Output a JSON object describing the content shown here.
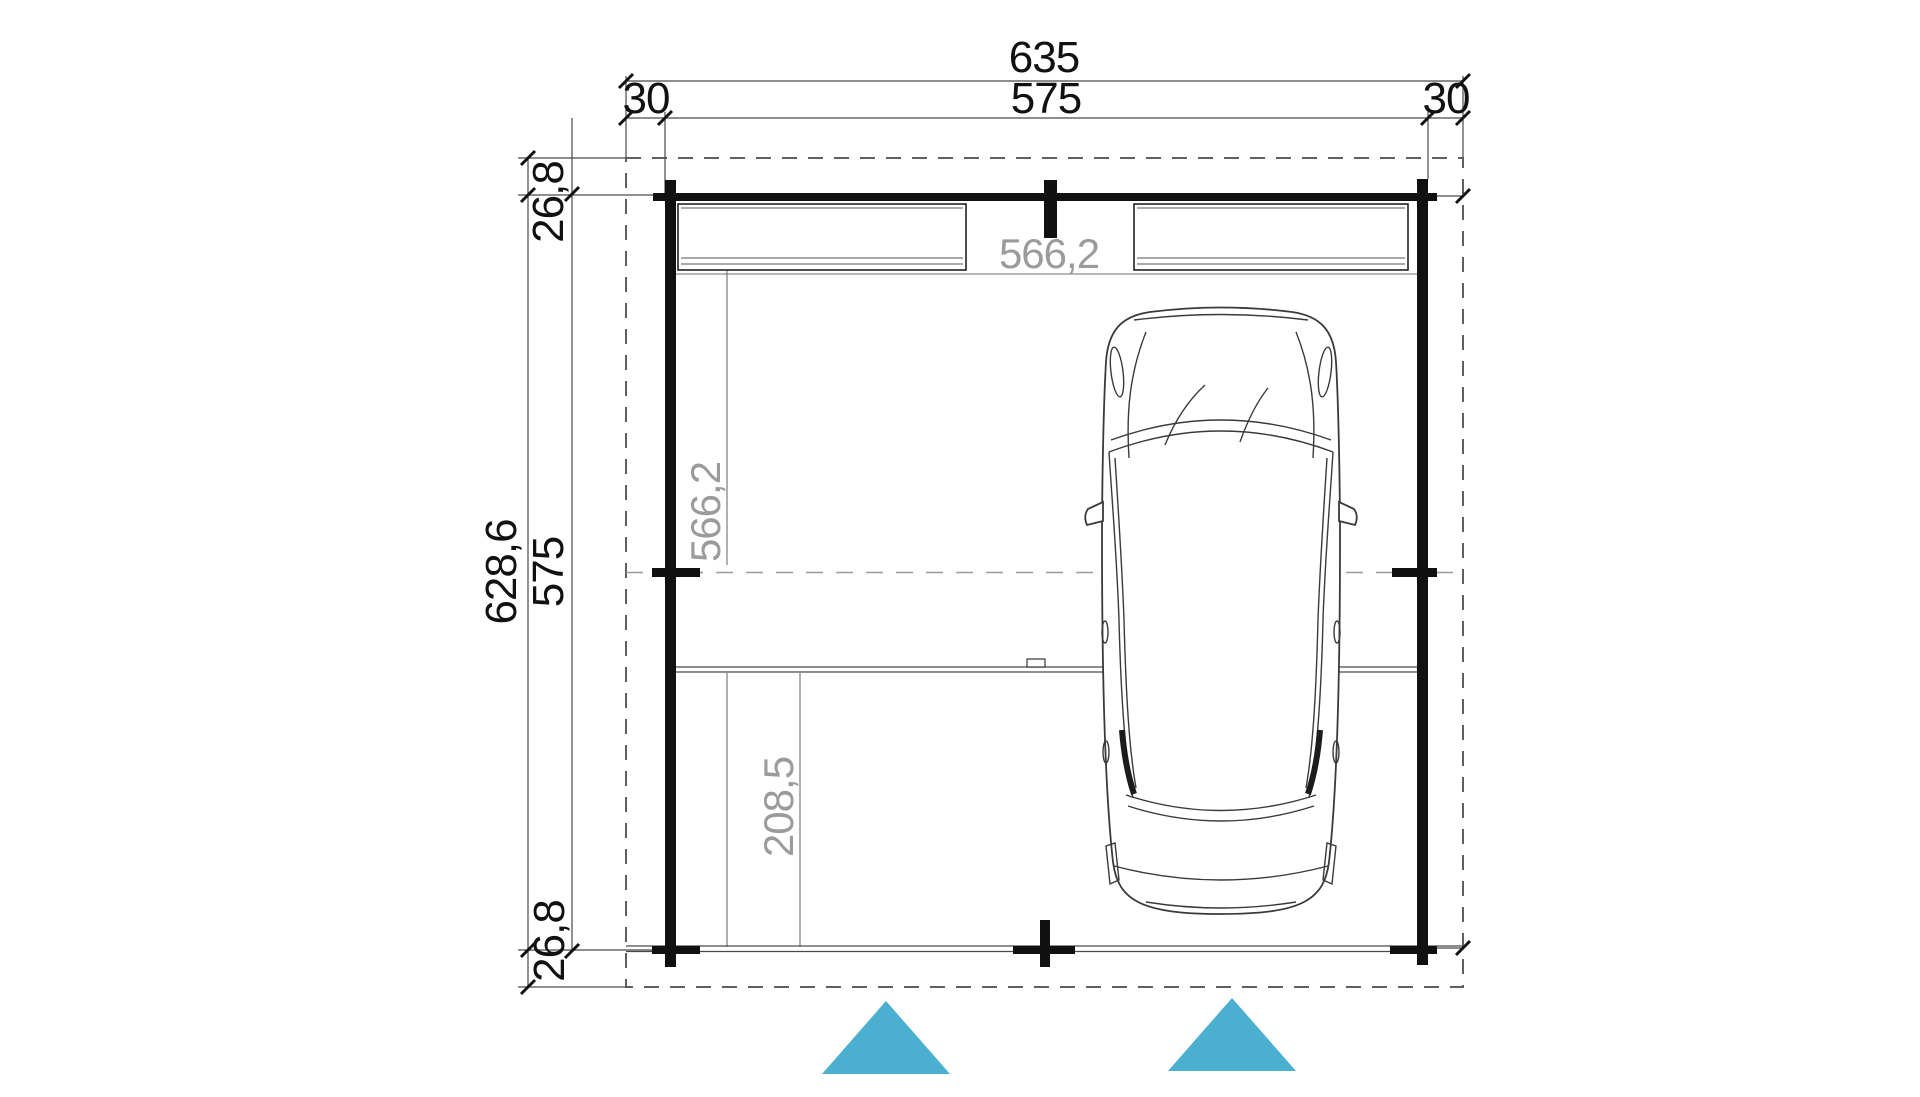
{
  "drawing": {
    "type": "carport-floor-plan",
    "labels": {
      "top": {
        "overall": "635",
        "left_overhang": "30",
        "wall_span": "575",
        "right_overhang": "30"
      },
      "left": {
        "overall": "628,6",
        "wall_span": "575",
        "top_overhang": "26,8",
        "bottom_overhang": "26,8"
      },
      "interior": {
        "width": "566,2",
        "depth": "566,2",
        "rear_section": "208,5"
      }
    },
    "icons": {
      "entrance_arrow": "triangle-up-icon"
    },
    "colors": {
      "accent": "#4bafd0",
      "wall": "#111111",
      "gray_text": "#9b9b9b",
      "dash": "#8a8a8a"
    }
  }
}
